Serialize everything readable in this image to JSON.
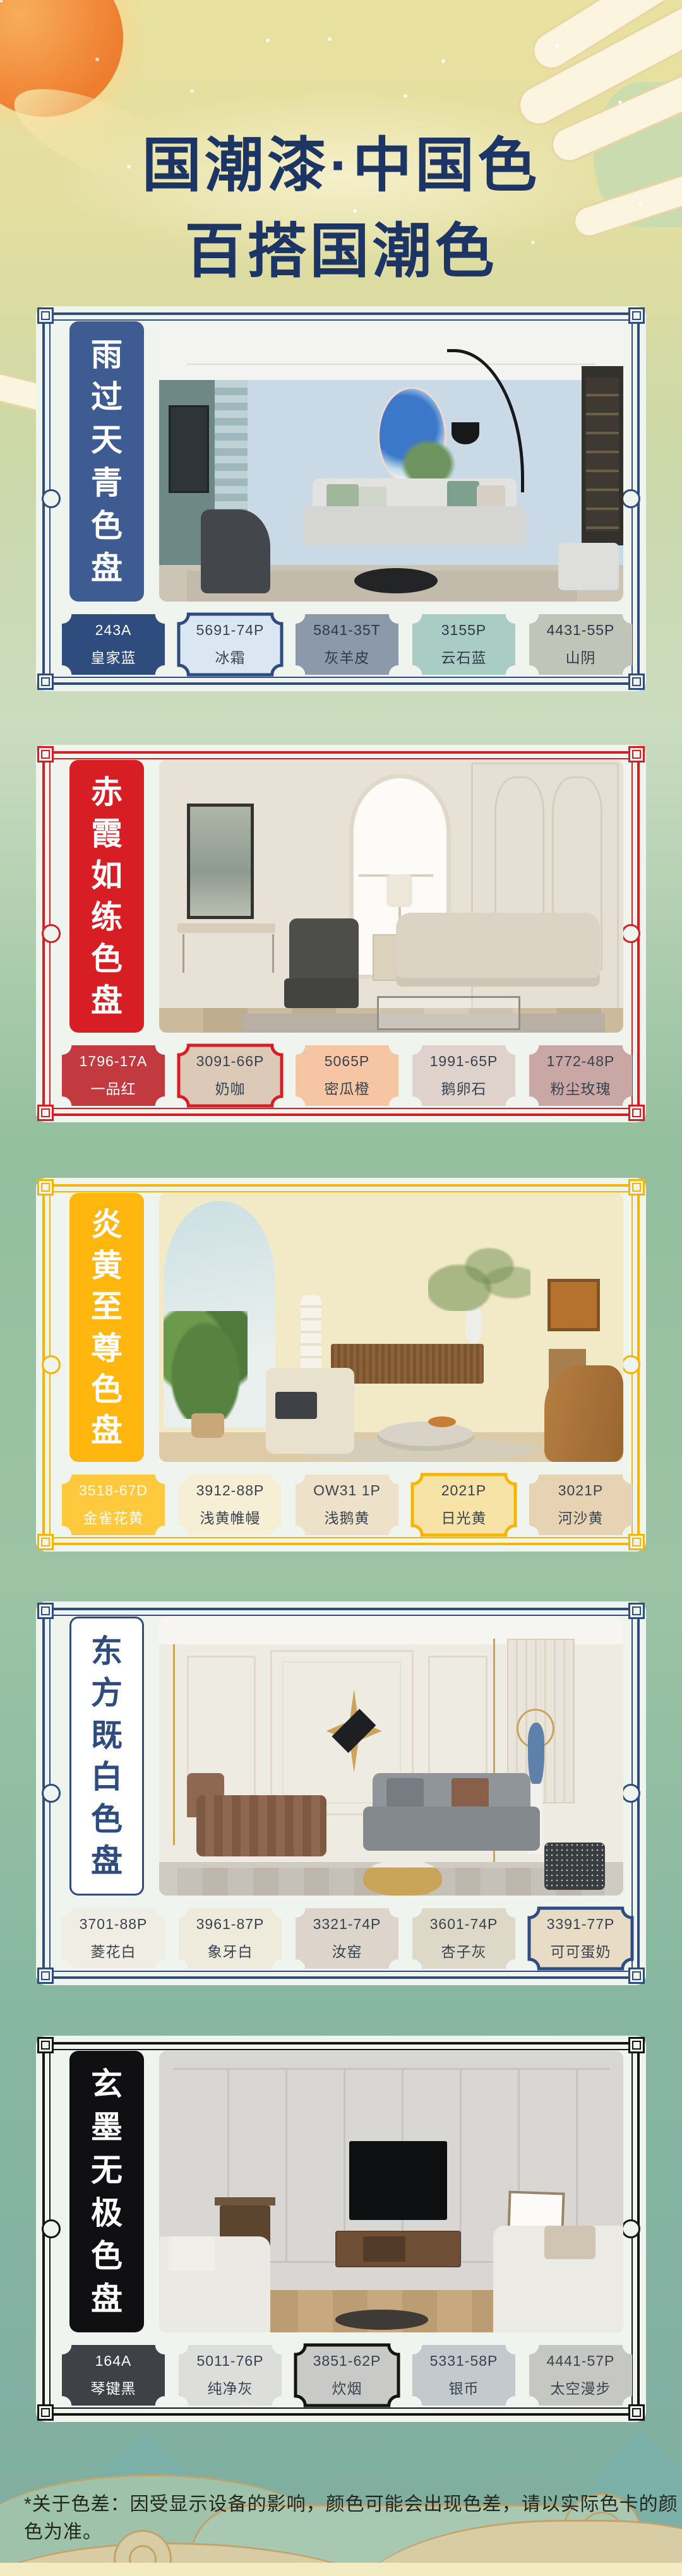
{
  "header": {
    "title_line1": "国潮漆·中国色",
    "title_line2": "百搭国潮色",
    "text_color": "#1C3564"
  },
  "footnote": "*关于色差：因受显示设备的影响，颜色可能会出现色差，请以实际色卡的颜色为准。",
  "palettes": [
    {
      "name": "雨过天青色盘",
      "theme": "#2E4C80",
      "title_bg": "#3E5C92",
      "title_text": "#FFFFFF",
      "title_border": false,
      "swatches": [
        {
          "code": "243A",
          "name": "皇家蓝",
          "color": "#2F4C7E",
          "text_color": "#FFFFFF",
          "outlined": false
        },
        {
          "code": "5691-74P",
          "name": "冰霜",
          "color": "#DAE7F2",
          "text_color": "#39434E",
          "outlined": true
        },
        {
          "code": "5841-35T",
          "name": "灰羊皮",
          "color": "#8C99AA",
          "text_color": "#2F3A47",
          "outlined": false
        },
        {
          "code": "3155P",
          "name": "云石蓝",
          "color": "#A9CCC4",
          "text_color": "#2F3A47",
          "outlined": false
        },
        {
          "code": "4431-55P",
          "name": "山阴",
          "color": "#C0C4B9",
          "text_color": "#2F3A47",
          "outlined": false
        }
      ]
    },
    {
      "name": "赤霞如练色盘",
      "theme": "#D81E25",
      "title_bg": "#D81E25",
      "title_text": "#FFFFFF",
      "title_border": false,
      "swatches": [
        {
          "code": "1796-17A",
          "name": "一品红",
          "color": "#C23A40",
          "text_color": "#FFFFFF",
          "outlined": false
        },
        {
          "code": "3091-66P",
          "name": "奶咖",
          "color": "#DCC9B8",
          "text_color": "#39434E",
          "outlined": true
        },
        {
          "code": "5065P",
          "name": "密瓜橙",
          "color": "#F6C5A3",
          "text_color": "#39434E",
          "outlined": false
        },
        {
          "code": "1991-65P",
          "name": "鹅卵石",
          "color": "#DFD2CD",
          "text_color": "#39434E",
          "outlined": false
        },
        {
          "code": "1772-48P",
          "name": "粉尘玫瑰",
          "color": "#C9A7A4",
          "text_color": "#39434E",
          "outlined": false
        }
      ]
    },
    {
      "name": "炎黄至尊色盘",
      "theme": "#F7B500",
      "title_bg": "#FFB60E",
      "title_text": "#FFFFFF",
      "title_border": false,
      "swatches": [
        {
          "code": "3518-67D",
          "name": "金雀花黄",
          "color": "#FFC93E",
          "text_color": "#FFFDF2",
          "outlined": false
        },
        {
          "code": "3912-88P",
          "name": "浅黄帷幔",
          "color": "#F6EFD5",
          "text_color": "#39434E",
          "outlined": false
        },
        {
          "code": "OW31 1P",
          "name": "浅鹅黄",
          "color": "#EDE1C9",
          "text_color": "#39434E",
          "outlined": false
        },
        {
          "code": "2021P",
          "name": "日光黄",
          "color": "#F8E3A7",
          "text_color": "#39434E",
          "outlined": true
        },
        {
          "code": "3021P",
          "name": "河沙黄",
          "color": "#E7D3B3",
          "text_color": "#39434E",
          "outlined": false
        }
      ]
    },
    {
      "name": "东方既白色盘",
      "theme": "#2E4C80",
      "title_bg": "#FFFFFF",
      "title_text": "#2E4C80",
      "title_border": true,
      "swatches": [
        {
          "code": "3701-88P",
          "name": "菱花白",
          "color": "#F0EEE4",
          "text_color": "#39434E",
          "outlined": false
        },
        {
          "code": "3961-87P",
          "name": "象牙白",
          "color": "#EFEBDC",
          "text_color": "#39434E",
          "outlined": false
        },
        {
          "code": "3321-74P",
          "name": "汝窑",
          "color": "#DDD5CC",
          "text_color": "#39434E",
          "outlined": false
        },
        {
          "code": "3601-74P",
          "name": "杏子灰",
          "color": "#DED8C8",
          "text_color": "#39434E",
          "outlined": false
        },
        {
          "code": "3391-77P",
          "name": "可可蛋奶",
          "color": "#E9DCC7",
          "text_color": "#39434E",
          "outlined": true
        }
      ]
    },
    {
      "name": "玄墨无极色盘",
      "theme": "#141414",
      "title_bg": "#101013",
      "title_text": "#FFFFFF",
      "title_border": false,
      "swatches": [
        {
          "code": "164A",
          "name": "琴键黑",
          "color": "#3E4146",
          "text_color": "#FFFFFF",
          "outlined": false
        },
        {
          "code": "5011-76P",
          "name": "纯净灰",
          "color": "#DDDDDC",
          "text_color": "#39434E",
          "outlined": false
        },
        {
          "code": "3851-62P",
          "name": "炊烟",
          "color": "#C9C9C7",
          "text_color": "#39434E",
          "outlined": true
        },
        {
          "code": "5331-58P",
          "name": "银币",
          "color": "#C2CACD",
          "text_color": "#39434E",
          "outlined": false
        },
        {
          "code": "4441-57P",
          "name": "太空漫步",
          "color": "#C6C6C2",
          "text_color": "#39434E",
          "outlined": false
        }
      ]
    }
  ]
}
